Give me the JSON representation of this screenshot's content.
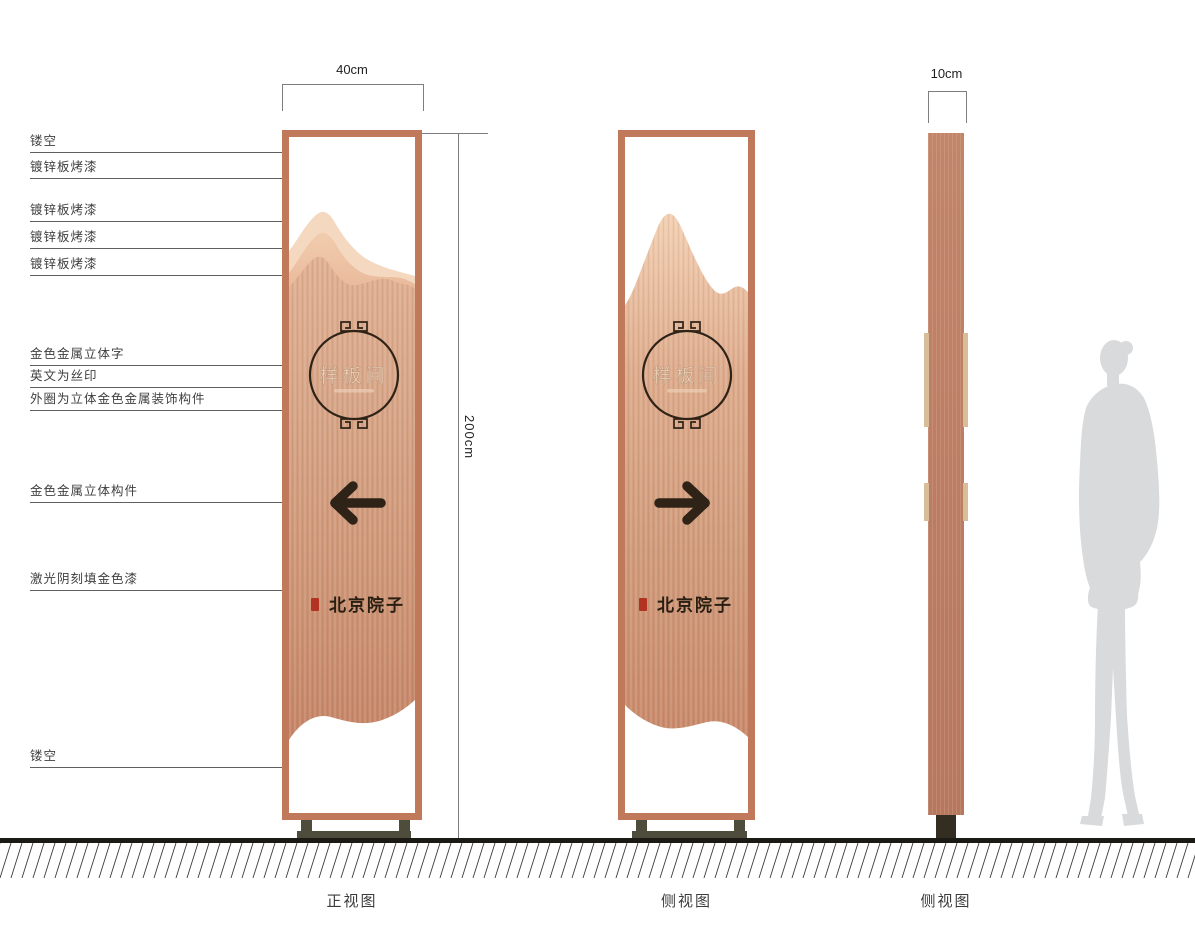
{
  "dimensions": {
    "width": "40cm",
    "height": "200cm",
    "thickness": "10cm"
  },
  "annotations": [
    {
      "label": "镂空"
    },
    {
      "label": "镀锌板烤漆"
    },
    {
      "label": "镀锌板烤漆"
    },
    {
      "label": "镀锌板烤漆"
    },
    {
      "label": "镀锌板烤漆"
    },
    {
      "label": "金色金属立体字"
    },
    {
      "label": "英文为丝印"
    },
    {
      "label": "外圈为立体金色金属装饰构件"
    },
    {
      "label": "金色金属立体构件"
    },
    {
      "label": "激光阴刻填金色漆"
    },
    {
      "label": "镂空"
    }
  ],
  "sign": {
    "medallion_text": "样板间",
    "brand_text": "北京院子",
    "icons": {
      "front_arrow": "arrow-left",
      "side_arrow": "arrow-right",
      "medallion_ornament": "greek-key-fret",
      "seal": "red-seal-stamp"
    }
  },
  "captions": {
    "front": "正视图",
    "side1": "侧视图",
    "side2": "侧视图"
  },
  "colors": {
    "frame": "#c1795c",
    "panel_top": "#e0b092",
    "panel_bottom": "#c58467",
    "mountain_back": "#f4d8c0",
    "mountain_mid": "#eec5a6",
    "accent_dark": "#2f2318",
    "medallion_text": "#ecd3b8",
    "seal_red": "#b23322",
    "base": "#4e4c3a",
    "profile_strip": "#d8bd9b",
    "silhouette": "#d9dadc",
    "ground": "#1c1a15"
  }
}
